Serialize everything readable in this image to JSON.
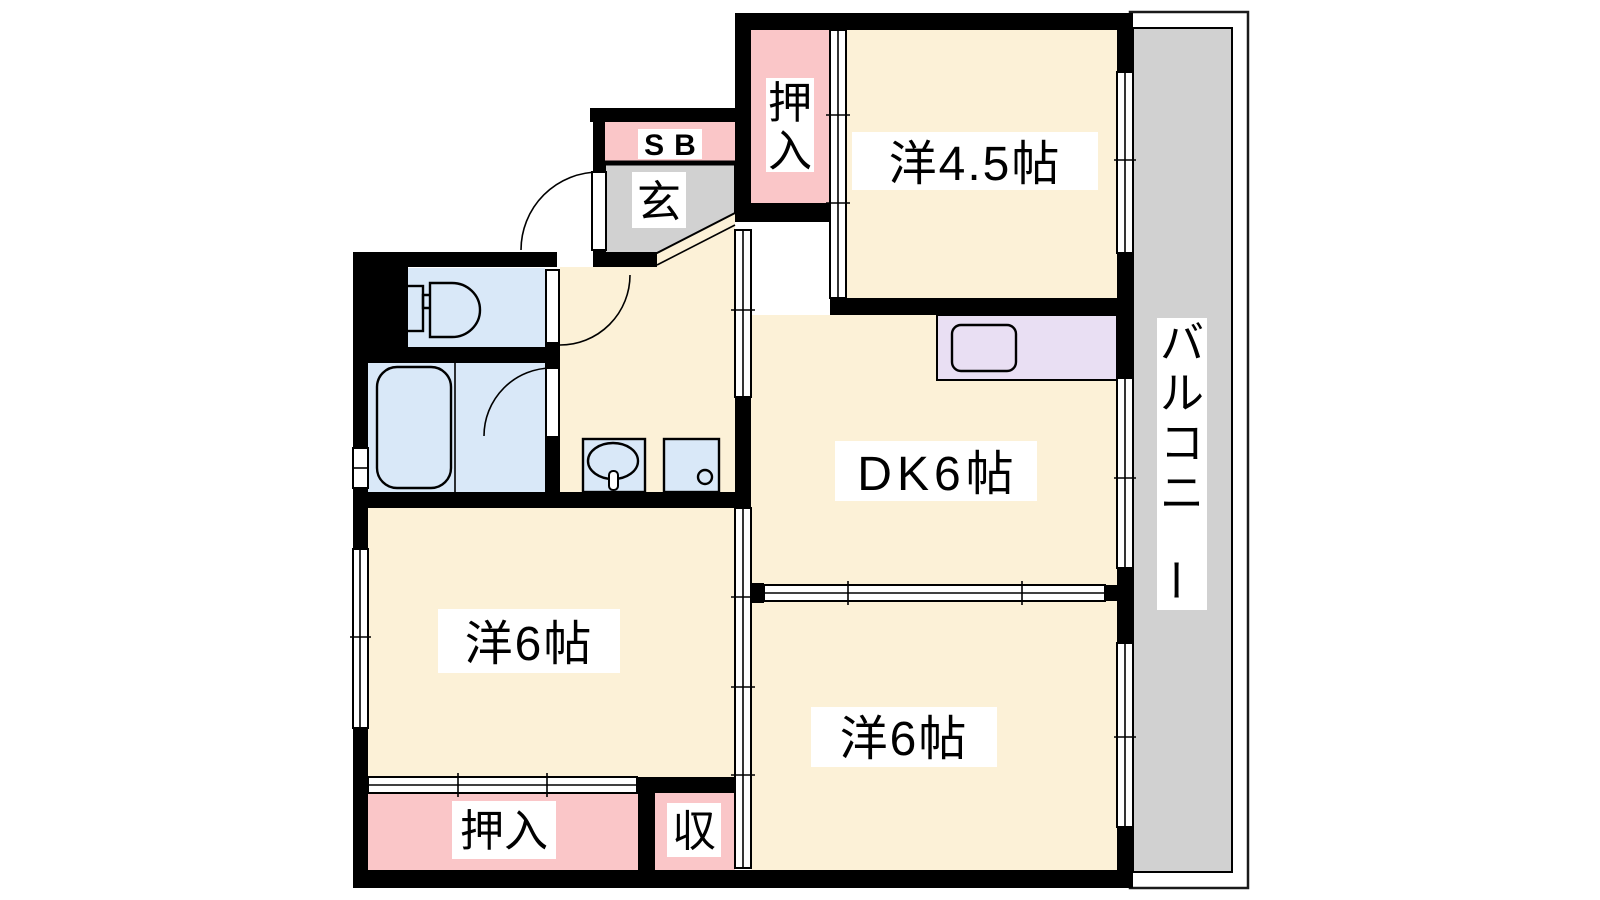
{
  "colors": {
    "wall": "#000000",
    "line": "#000000",
    "room_cream": "#FCF1D7",
    "closet_pink": "#FAC6C8",
    "fixture_blue": "#D9E8F8",
    "kitchen_purple": "#E9DFF3",
    "entry_gray": "#D1D1D1",
    "label_bg": "#FFFFFF",
    "text": "#000000"
  },
  "rooms": {
    "western45": {
      "label": "洋4.5帖"
    },
    "dk": {
      "label": "DK6帖"
    },
    "western6_left": {
      "label": "洋6帖"
    },
    "western6_bottom": {
      "label": "洋6帖"
    },
    "closet_top": {
      "label": "押入"
    },
    "closet_bottom": {
      "label": "押入"
    },
    "storage": {
      "label": "収"
    },
    "shoe_box": {
      "label": "SB"
    },
    "entrance": {
      "label": "玄"
    },
    "balcony": {
      "label": "バルコニー"
    }
  }
}
